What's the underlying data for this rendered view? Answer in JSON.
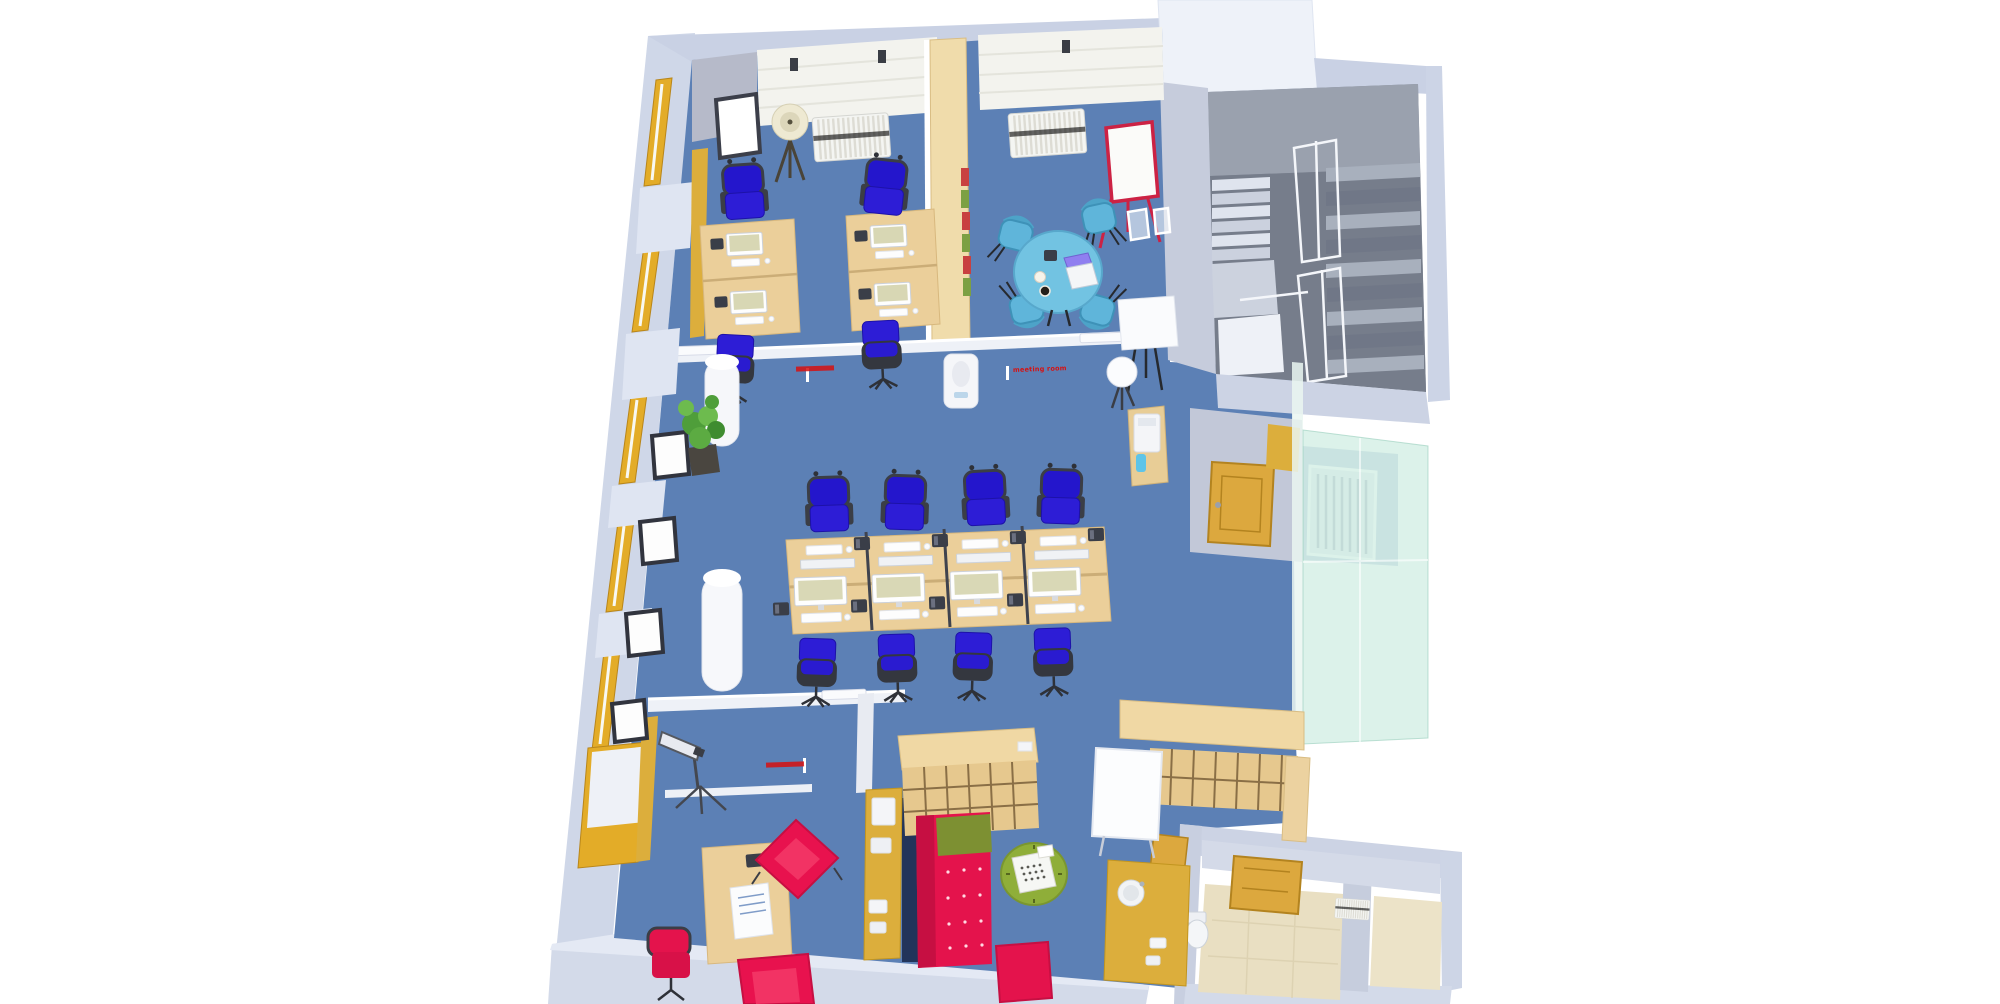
{
  "scene": {
    "type": "3d-floorplan-render",
    "description": "Isometric 3D render of a single office floor: private office and meeting room along the top, central open-plan desk bank of eight workstations on blue carpet, stairwell top-right, glass-walled enclosure mid-right, lounge with red chesterfield sofa and green round table at bottom-centre, small reception office bottom-left, kitchenette counter and two washrooms bottom-right."
  },
  "annotations": {
    "office_label": {
      "text": "",
      "legible": false
    },
    "meeting_room_label": {
      "text": "meeting room",
      "legible": true
    },
    "reception_label": {
      "text": "",
      "legible": false
    }
  },
  "rooms": [
    "private office",
    "meeting room",
    "stairwell",
    "open plan area",
    "lounge",
    "reception office",
    "kitchenette",
    "washrooms",
    "glass enclosure"
  ],
  "inventory": {
    "workstations_open_plan": 8,
    "workstations_private_office": 4,
    "blue_task_chairs": 12,
    "meeting_table_seats": 4,
    "meeting_tables": 1,
    "laptops_on_meeting_table": 1,
    "flipchart_easels": 1,
    "red_armchairs": 2,
    "red_task_chairs": 1,
    "red_sofas": 1,
    "red_ottomans": 1,
    "green_round_tables": 1,
    "typewriters": 1,
    "bookshelf_units": 3,
    "whiteboard_panels": 1,
    "floor_lamps": 1,
    "telescopes": 1,
    "potted_plants": 1,
    "round_columns": 2,
    "radiators": 4,
    "staircases": 1,
    "wooden_doors": 3,
    "toilets": 1,
    "sinks": 1,
    "printers": 1,
    "desk_phones": 14
  },
  "colors": {
    "carpet_blue": "#5C80B5",
    "outer_wall": "#CDD5E7",
    "inner_wall_gray": "#B6BAC9",
    "brick_white": "#F3F3EE",
    "desk_wood": "#EBCF9A",
    "window_wood": "#E3AC28",
    "door_wood": "#DCA83E",
    "task_chair_blue": "#2D1DD6",
    "meeting_blue": "#72C3E2",
    "accent_red": "#E4134C",
    "olive_green": "#8FAE39",
    "stair_gray": "#767D8B",
    "tile_beige": "#E9DFC2",
    "glass_green": "#BFE4D4",
    "label_red": "#D61111"
  }
}
